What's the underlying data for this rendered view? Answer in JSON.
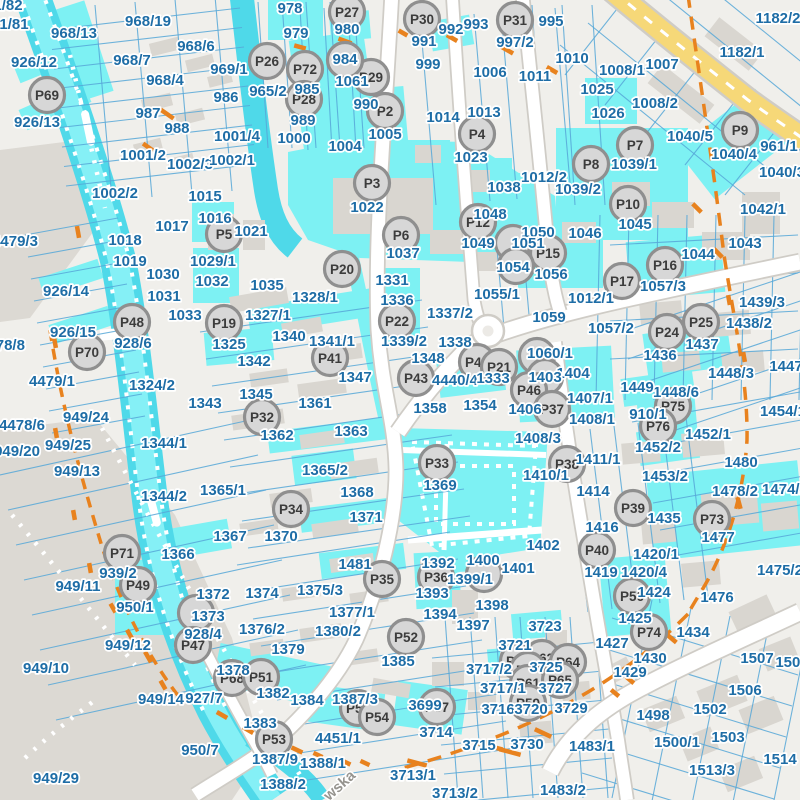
{
  "map": {
    "street_label": "wska",
    "colors": {
      "background": "#f0efeb",
      "gray_zone": "#dcd9d3",
      "building": "#d9d6d0",
      "parcel_line": "#57a8d8",
      "highlight": "#7df1f3",
      "water": "#4fd9e9",
      "water_light": "#85f0f6",
      "road_fill": "#ffffff",
      "road_casing": "#cfccc6",
      "yellow_road": "#f6d878",
      "orange": "#e8821e",
      "label_text": "#1e6da6",
      "marker_fill": "#d7d7d7",
      "marker_stroke": "#8f8f8f",
      "marker_text": "#3c3c3c",
      "street_text": "#96948f"
    },
    "parcel_labels": [
      [
        "1/82",
        8,
        5
      ],
      [
        "1/81",
        14,
        24
      ],
      [
        "968/13",
        74,
        33
      ],
      [
        "968/19",
        148,
        21
      ],
      [
        "926/12",
        34,
        62
      ],
      [
        "968/6",
        196,
        46
      ],
      [
        "968/7",
        132,
        60
      ],
      [
        "968/4",
        165,
        80
      ],
      [
        "987",
        148,
        113
      ],
      [
        "988",
        177,
        128
      ],
      [
        "926/13",
        37,
        122
      ],
      [
        "1001/2",
        143,
        155
      ],
      [
        "1002/3",
        190,
        164
      ],
      [
        "1001/4",
        237,
        136
      ],
      [
        "1002/2",
        115,
        193
      ],
      [
        "1002/1",
        232,
        160
      ],
      [
        "1015",
        205,
        196
      ],
      [
        "1016",
        215,
        218
      ],
      [
        "1017",
        172,
        226
      ],
      [
        "1018",
        125,
        240
      ],
      [
        "1019",
        130,
        261
      ],
      [
        "1030",
        163,
        274
      ],
      [
        "1031",
        164,
        296
      ],
      [
        "1033",
        185,
        315
      ],
      [
        "4479/3",
        15,
        241
      ],
      [
        "926/14",
        66,
        291
      ],
      [
        "926/15",
        73,
        332
      ],
      [
        "4478/8",
        2,
        345
      ],
      [
        "928/6",
        133,
        343
      ],
      [
        "4479/1",
        52,
        381
      ],
      [
        "1324/2",
        152,
        385
      ],
      [
        "1021",
        251,
        231
      ],
      [
        "1029/1",
        213,
        261
      ],
      [
        "1032",
        212,
        281
      ],
      [
        "1035",
        267,
        285
      ],
      [
        "978",
        290,
        8
      ],
      [
        "979",
        296,
        33
      ],
      [
        "980",
        347,
        29
      ],
      [
        "969/1",
        229,
        69
      ],
      [
        "986",
        226,
        97
      ],
      [
        "965/2",
        268,
        91
      ],
      [
        "984",
        345,
        59
      ],
      [
        "985",
        307,
        89
      ],
      [
        "989",
        303,
        120
      ],
      [
        "1000",
        294,
        138
      ],
      [
        "990",
        366,
        104
      ],
      [
        "1005",
        385,
        134
      ],
      [
        "1004",
        345,
        146
      ],
      [
        "1061",
        352,
        81
      ],
      [
        "1022",
        367,
        207
      ],
      [
        "1037",
        403,
        253
      ],
      [
        "991",
        424,
        41
      ],
      [
        "992",
        451,
        29
      ],
      [
        "993",
        476,
        24
      ],
      [
        "995",
        551,
        21
      ],
      [
        "997/2",
        515,
        42
      ],
      [
        "999",
        428,
        64
      ],
      [
        "1006",
        490,
        72
      ],
      [
        "1010",
        572,
        58
      ],
      [
        "1011",
        535,
        76
      ],
      [
        "1014",
        443,
        117
      ],
      [
        "1013",
        484,
        112
      ],
      [
        "1023",
        471,
        157
      ],
      [
        "1038",
        504,
        187
      ],
      [
        "1012/2",
        544,
        177
      ],
      [
        "1039/2",
        578,
        189
      ],
      [
        "1039/1",
        634,
        164
      ],
      [
        "1025",
        597,
        89
      ],
      [
        "1026",
        608,
        113
      ],
      [
        "1182/2",
        778,
        18
      ],
      [
        "1182/1",
        742,
        52
      ],
      [
        "1007",
        662,
        64
      ],
      [
        "1008/1",
        622,
        70
      ],
      [
        "1008/2",
        655,
        103
      ],
      [
        "1040/5",
        690,
        136
      ],
      [
        "1040/4",
        734,
        154
      ],
      [
        "961/1",
        779,
        146
      ],
      [
        "1040/3",
        782,
        172
      ],
      [
        "1042/1",
        763,
        209
      ],
      [
        "1043",
        745,
        243
      ],
      [
        "1044",
        698,
        254
      ],
      [
        "1045",
        635,
        224
      ],
      [
        "1012/1",
        591,
        298
      ],
      [
        "1057/2",
        611,
        328
      ],
      [
        "1057/3",
        663,
        286
      ],
      [
        "1046",
        585,
        233
      ],
      [
        "1048",
        490,
        214
      ],
      [
        "1050",
        538,
        232
      ],
      [
        "1049",
        478,
        243
      ],
      [
        "1051",
        528,
        243
      ],
      [
        "1054",
        513,
        267
      ],
      [
        "1056",
        551,
        274
      ],
      [
        "1055/1",
        497,
        294
      ],
      [
        "1059",
        549,
        317
      ],
      [
        "1436",
        660,
        355
      ],
      [
        "1437",
        702,
        344
      ],
      [
        "1438/2",
        749,
        323
      ],
      [
        "1439/3",
        762,
        302
      ],
      [
        "1448/3",
        731,
        373
      ],
      [
        "1448/6",
        676,
        392
      ],
      [
        "1449",
        637,
        387
      ],
      [
        "1447",
        786,
        366
      ],
      [
        "910/1",
        648,
        414
      ],
      [
        "1454/1",
        783,
        411
      ],
      [
        "1452/1",
        708,
        434
      ],
      [
        "1452/2",
        658,
        447
      ],
      [
        "1453/2",
        665,
        476
      ],
      [
        "1480",
        741,
        462
      ],
      [
        "1478/2",
        735,
        491
      ],
      [
        "1474/1",
        785,
        489
      ],
      [
        "1435",
        664,
        518
      ],
      [
        "1477",
        718,
        537
      ],
      [
        "1475/2",
        780,
        570
      ],
      [
        "1476",
        717,
        597
      ],
      [
        "1328/1",
        315,
        297
      ],
      [
        "1327/1",
        268,
        315
      ],
      [
        "1331",
        392,
        280
      ],
      [
        "1336",
        397,
        300
      ],
      [
        "1340",
        289,
        336
      ],
      [
        "1341/1",
        332,
        341
      ],
      [
        "1325",
        229,
        344
      ],
      [
        "1342",
        254,
        361
      ],
      [
        "1345",
        256,
        394
      ],
      [
        "1347",
        355,
        377
      ],
      [
        "1343",
        205,
        403
      ],
      [
        "1337/2",
        450,
        313
      ],
      [
        "1339/2",
        404,
        341
      ],
      [
        "1338",
        455,
        342
      ],
      [
        "1348",
        428,
        358
      ],
      [
        "1060/1",
        550,
        353
      ],
      [
        "1404",
        573,
        373
      ],
      [
        "1403",
        545,
        377
      ],
      [
        "4440/4",
        455,
        380
      ],
      [
        "1333",
        493,
        378
      ],
      [
        "1406",
        525,
        409
      ],
      [
        "1407/1",
        590,
        398
      ],
      [
        "1408/1",
        592,
        419
      ],
      [
        "1408/3",
        538,
        438
      ],
      [
        "1410/1",
        546,
        475
      ],
      [
        "1411/1",
        598,
        459
      ],
      [
        "1414",
        593,
        491
      ],
      [
        "1416",
        602,
        527
      ],
      [
        "1358",
        430,
        408
      ],
      [
        "1354",
        480,
        405
      ],
      [
        "1369",
        440,
        485
      ],
      [
        "1361",
        315,
        403
      ],
      [
        "1362",
        277,
        435
      ],
      [
        "1363",
        351,
        431
      ],
      [
        "1365/2",
        325,
        470
      ],
      [
        "1365/1",
        223,
        490
      ],
      [
        "1368",
        357,
        492
      ],
      [
        "1367",
        230,
        536
      ],
      [
        "1370",
        281,
        536
      ],
      [
        "1371",
        366,
        517
      ],
      [
        "1481",
        355,
        564
      ],
      [
        "1344/1",
        164,
        443
      ],
      [
        "1344/2",
        164,
        496
      ],
      [
        "1366",
        178,
        554
      ],
      [
        "949/24",
        86,
        417
      ],
      [
        "4478/6",
        22,
        425
      ],
      [
        "949/20",
        17,
        451
      ],
      [
        "949/25",
        68,
        445
      ],
      [
        "949/13",
        77,
        471
      ],
      [
        "939/2",
        118,
        573
      ],
      [
        "949/11",
        78,
        586
      ],
      [
        "1392",
        438,
        563
      ],
      [
        "1400",
        483,
        560
      ],
      [
        "1399/1",
        470,
        579
      ],
      [
        "1401",
        518,
        568
      ],
      [
        "1402",
        543,
        545
      ],
      [
        "1393",
        432,
        593
      ],
      [
        "1394",
        440,
        614
      ],
      [
        "1398",
        492,
        605
      ],
      [
        "1397",
        473,
        625
      ],
      [
        "1385",
        398,
        661
      ],
      [
        "1372",
        213,
        594
      ],
      [
        "1374",
        262,
        593
      ],
      [
        "1375/3",
        320,
        590
      ],
      [
        "1373",
        208,
        616
      ],
      [
        "1376/2",
        262,
        629
      ],
      [
        "1377/1",
        352,
        612
      ],
      [
        "1380/2",
        338,
        631
      ],
      [
        "1379",
        288,
        649
      ],
      [
        "1378",
        233,
        670
      ],
      [
        "928/4",
        203,
        634
      ],
      [
        "927/7",
        204,
        698
      ],
      [
        "950/7",
        200,
        750
      ],
      [
        "1382",
        273,
        693
      ],
      [
        "1384",
        307,
        700
      ],
      [
        "1387/3",
        355,
        699
      ],
      [
        "1383",
        260,
        723
      ],
      [
        "4451/1",
        338,
        738
      ],
      [
        "1387/9",
        275,
        759
      ],
      [
        "1388/1",
        323,
        763
      ],
      [
        "1388/2",
        283,
        784
      ],
      [
        "950/1",
        135,
        607
      ],
      [
        "949/12",
        128,
        645
      ],
      [
        "949/10",
        46,
        668
      ],
      [
        "949/14",
        161,
        699
      ],
      [
        "949/29",
        56,
        778
      ],
      [
        "3699",
        425,
        705
      ],
      [
        "3714",
        436,
        732
      ],
      [
        "3715",
        479,
        745
      ],
      [
        "3730",
        527,
        744
      ],
      [
        "3713/1",
        413,
        775
      ],
      [
        "3713/2",
        455,
        793
      ],
      [
        "3723",
        545,
        626
      ],
      [
        "3721",
        515,
        645
      ],
      [
        "3717/2",
        489,
        669
      ],
      [
        "3725",
        546,
        667
      ],
      [
        "3717/1",
        503,
        688
      ],
      [
        "3727",
        555,
        688
      ],
      [
        "3716",
        498,
        709
      ],
      [
        "3720",
        531,
        709
      ],
      [
        "3729",
        571,
        708
      ],
      [
        "1483/2",
        563,
        790
      ],
      [
        "1483/1",
        592,
        746
      ],
      [
        "1419",
        601,
        572
      ],
      [
        "1420/1",
        656,
        554
      ],
      [
        "1420/4",
        644,
        572
      ],
      [
        "1424",
        654,
        592
      ],
      [
        "1425",
        635,
        618
      ],
      [
        "1427",
        612,
        643
      ],
      [
        "1430",
        650,
        658
      ],
      [
        "1429",
        630,
        672
      ],
      [
        "1434",
        693,
        632
      ],
      [
        "1507",
        757,
        658
      ],
      [
        "1508",
        792,
        662
      ],
      [
        "1506",
        745,
        690
      ],
      [
        "1502",
        710,
        709
      ],
      [
        "1498",
        653,
        715
      ],
      [
        "1500/1",
        677,
        742
      ],
      [
        "1503",
        728,
        737
      ],
      [
        "1513/3",
        712,
        770
      ],
      [
        "1514",
        780,
        759
      ]
    ],
    "markers": [
      [
        "P69",
        47,
        95
      ],
      [
        "P26",
        267,
        61
      ],
      [
        "P72",
        305,
        69
      ],
      [
        "P27",
        347,
        12
      ],
      [
        "P30",
        422,
        19
      ],
      [
        "P31",
        515,
        20
      ],
      [
        "P29",
        371,
        77
      ],
      [
        "P28",
        304,
        99
      ],
      [
        "P2",
        385,
        111
      ],
      [
        "",
        345,
        60
      ],
      [
        "P4",
        477,
        134
      ],
      [
        "P3",
        372,
        183
      ],
      [
        "P8",
        591,
        164
      ],
      [
        "P7",
        635,
        145
      ],
      [
        "P9",
        740,
        130
      ],
      [
        "P10",
        628,
        204
      ],
      [
        "P5",
        224,
        234
      ],
      [
        "P6",
        401,
        235
      ],
      [
        "P12",
        478,
        222
      ],
      [
        "",
        513,
        243
      ],
      [
        "P15",
        548,
        253
      ],
      [
        "",
        516,
        266
      ],
      [
        "P20",
        342,
        269
      ],
      [
        "P17",
        622,
        281
      ],
      [
        "P16",
        665,
        265
      ],
      [
        "P48",
        132,
        322
      ],
      [
        "P19",
        224,
        323
      ],
      [
        "P70",
        87,
        352
      ],
      [
        "P22",
        397,
        321
      ],
      [
        "P25",
        701,
        322
      ],
      [
        "P24",
        667,
        332
      ],
      [
        "P41",
        330,
        358
      ],
      [
        "P42",
        477,
        362
      ],
      [
        "P21",
        499,
        367
      ],
      [
        "",
        537,
        356
      ],
      [
        "P43",
        416,
        378
      ],
      [
        "P45",
        545,
        377
      ],
      [
        "P46",
        529,
        390
      ],
      [
        "P37",
        552,
        409
      ],
      [
        "P32",
        262,
        417
      ],
      [
        "P33",
        437,
        463
      ],
      [
        "P38",
        567,
        464
      ],
      [
        "P34",
        291,
        509
      ],
      [
        "P39",
        633,
        508
      ],
      [
        "P71",
        122,
        553
      ],
      [
        "P40",
        597,
        550
      ],
      [
        "P35",
        382,
        579
      ],
      [
        "P49",
        138,
        585
      ],
      [
        "P36",
        436,
        577
      ],
      [
        "",
        484,
        574
      ],
      [
        "P75",
        673,
        406
      ],
      [
        "P76",
        658,
        426
      ],
      [
        "P73",
        712,
        519
      ],
      [
        "P56",
        632,
        596
      ],
      [
        "",
        196,
        613
      ],
      [
        "P47",
        193,
        645
      ],
      [
        "P74",
        649,
        632
      ],
      [
        "P52",
        406,
        637
      ],
      [
        "P68",
        232,
        678
      ],
      [
        "P51",
        261,
        677
      ],
      [
        "P60",
        518,
        661
      ],
      [
        "P62",
        542,
        658
      ],
      [
        "P64",
        568,
        662
      ],
      [
        "P63",
        528,
        670
      ],
      [
        "P61",
        528,
        683
      ],
      [
        "P65",
        560,
        680
      ],
      [
        "P59",
        528,
        703
      ],
      [
        "P57",
        437,
        707
      ],
      [
        "P55",
        358,
        708
      ],
      [
        "P54",
        377,
        717
      ],
      [
        "P53",
        274,
        739
      ]
    ]
  }
}
